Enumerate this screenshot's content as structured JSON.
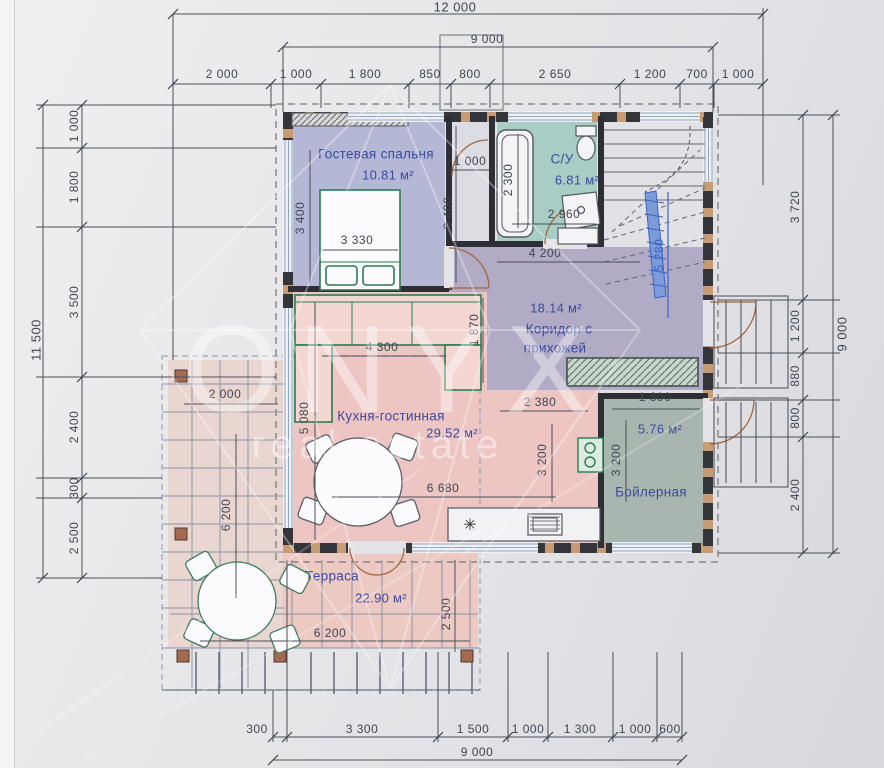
{
  "watermark": {
    "brand": "ONYX",
    "tagline": "real estate"
  },
  "rooms": {
    "bedroom": {
      "name": "Гостевая спальня",
      "area": "10.81 м²",
      "color": "#b4b8d5"
    },
    "bathroom": {
      "name": "С/У",
      "area": "6.81 м²",
      "color": "#a7cdc4"
    },
    "hallway": {
      "name_line1": "Коридор с",
      "name_line2": "прихожей",
      "area": "18.14 м²",
      "color": "#b1abc5"
    },
    "kitchen": {
      "name": "Кухня-гостинная",
      "area": "29.52 м²",
      "color": "#edc6c4"
    },
    "boiler": {
      "name": "Бойлерная",
      "area": "5.76 м²",
      "color": "#a9b6b0"
    },
    "terrace": {
      "name": "Терраса",
      "area": "22.90 м²",
      "color": "#ecccc5"
    }
  },
  "dimensions": [
    {
      "label": "12 000",
      "x": 455,
      "y": 7,
      "big": true
    },
    {
      "label": "9 000",
      "x": 487,
      "y": 39
    },
    {
      "label": "2 000",
      "x": 222,
      "y": 74
    },
    {
      "label": "1 000",
      "x": 296,
      "y": 74
    },
    {
      "label": "1 800",
      "x": 365,
      "y": 74
    },
    {
      "label": "850",
      "x": 430,
      "y": 74
    },
    {
      "label": "800",
      "x": 470,
      "y": 74
    },
    {
      "label": "2 650",
      "x": 555,
      "y": 74
    },
    {
      "label": "1 200",
      "x": 650,
      "y": 74
    },
    {
      "label": "700",
      "x": 697,
      "y": 74
    },
    {
      "label": "1 000",
      "x": 738,
      "y": 74
    },
    {
      "label": "11 500",
      "x": 36,
      "y": 340,
      "rot": true,
      "big": true
    },
    {
      "label": "1 000",
      "x": 74,
      "y": 126,
      "rot": true
    },
    {
      "label": "1 800",
      "x": 74,
      "y": 187,
      "rot": true
    },
    {
      "label": "3 500",
      "x": 74,
      "y": 302,
      "rot": true
    },
    {
      "label": "2 400",
      "x": 74,
      "y": 427,
      "rot": true
    },
    {
      "label": "300",
      "x": 74,
      "y": 488,
      "rot": true
    },
    {
      "label": "2 500",
      "x": 74,
      "y": 538,
      "rot": true
    },
    {
      "label": "9 000",
      "x": 842,
      "y": 334,
      "rot": true,
      "big": true
    },
    {
      "label": "3 720",
      "x": 795,
      "y": 207,
      "rot": true
    },
    {
      "label": "1 200",
      "x": 795,
      "y": 326,
      "rot": true
    },
    {
      "label": "880",
      "x": 795,
      "y": 376,
      "rot": true
    },
    {
      "label": "800",
      "x": 795,
      "y": 418,
      "rot": true
    },
    {
      "label": "2 400",
      "x": 795,
      "y": 495,
      "rot": true
    },
    {
      "label": "300",
      "x": 257,
      "y": 729
    },
    {
      "label": "3 300",
      "x": 362,
      "y": 729
    },
    {
      "label": "1 500",
      "x": 473,
      "y": 729
    },
    {
      "label": "1 000",
      "x": 528,
      "y": 729
    },
    {
      "label": "1 300",
      "x": 580,
      "y": 729
    },
    {
      "label": "1 000",
      "x": 635,
      "y": 729
    },
    {
      "label": "600",
      "x": 670,
      "y": 729
    },
    {
      "label": "9 000",
      "x": 477,
      "y": 752
    },
    {
      "label": "3 400",
      "x": 300,
      "y": 218,
      "rot": true
    },
    {
      "label": "3 330",
      "x": 357,
      "y": 240
    },
    {
      "label": "3 400",
      "x": 448,
      "y": 213,
      "rot": true
    },
    {
      "label": "1 000",
      "x": 470,
      "y": 161
    },
    {
      "label": "2 300",
      "x": 508,
      "y": 180,
      "rot": true
    },
    {
      "label": "2 960",
      "x": 564,
      "y": 214
    },
    {
      "label": "4 200",
      "x": 545,
      "y": 253
    },
    {
      "label": "5 280",
      "x": 659,
      "y": 255,
      "rot": true,
      "accent": true
    },
    {
      "label": "4 300",
      "x": 382,
      "y": 347
    },
    {
      "label": "1 870",
      "x": 474,
      "y": 330,
      "rot": true
    },
    {
      "label": "2 380",
      "x": 540,
      "y": 402
    },
    {
      "label": "5 080",
      "x": 304,
      "y": 418,
      "rot": true
    },
    {
      "label": "6 680",
      "x": 443,
      "y": 488
    },
    {
      "label": "3 200",
      "x": 542,
      "y": 460,
      "rot": true
    },
    {
      "label": "3 200",
      "x": 616,
      "y": 460,
      "rot": true
    },
    {
      "label": "1 800",
      "x": 655,
      "y": 397
    },
    {
      "label": "2 000",
      "x": 225,
      "y": 394
    },
    {
      "label": "6 200",
      "x": 226,
      "y": 515,
      "rot": true
    },
    {
      "label": "6 200",
      "x": 330,
      "y": 633
    },
    {
      "label": "2 500",
      "x": 446,
      "y": 614,
      "rot": true
    }
  ]
}
